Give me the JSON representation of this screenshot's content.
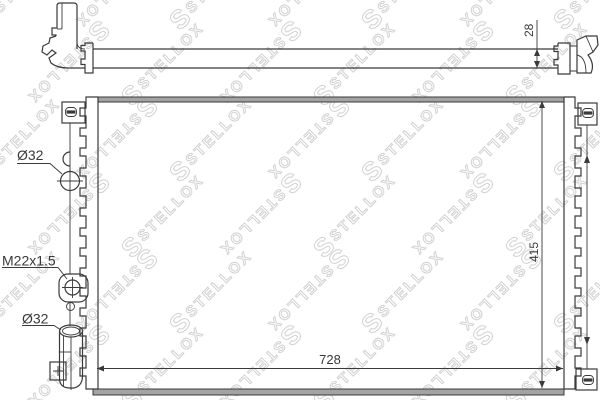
{
  "diagram": {
    "kind": "radiator-technical-drawing",
    "labels": {
      "port_top": "Ø32",
      "thread": "M22x1.5",
      "port_bottom": "Ø32"
    },
    "dimensions": {
      "inlet_pipe_height": "28",
      "core_height": "415",
      "core_width": "728"
    }
  },
  "watermark": {
    "logo_letter": "S",
    "text": "STELLOX",
    "color": "#d2d2d2"
  },
  "colors": {
    "line": "#3a3a3a",
    "band_fill": "#a3a3a3",
    "background": "#ffffff"
  }
}
